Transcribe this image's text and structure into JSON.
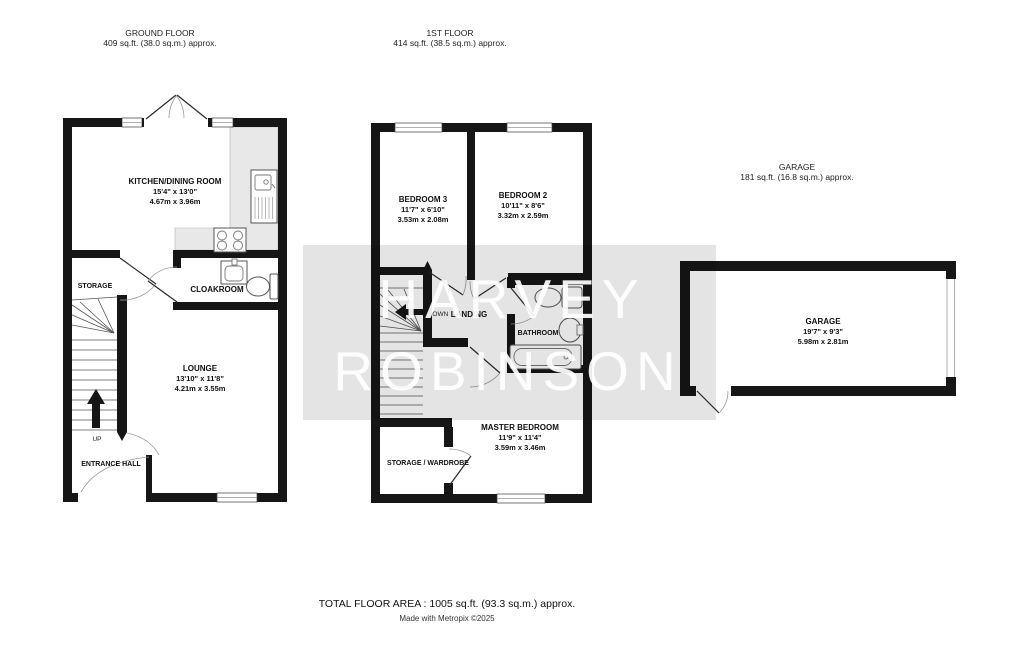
{
  "floors": {
    "ground": {
      "title": "GROUND FLOOR",
      "area": "409 sq.ft. (38.0 sq.m.) approx.",
      "rooms": {
        "kitchen": {
          "name": "KITCHEN/DINING ROOM",
          "imperial": "15'4\"  x 13'0\"",
          "metric": "4.67m  x 3.96m"
        },
        "lounge": {
          "name": "LOUNGE",
          "imperial": "13'10\"  x 11'8\"",
          "metric": "4.21m  x 3.55m"
        },
        "storage": {
          "name": "STORAGE"
        },
        "cloakroom": {
          "name": "CLOAKROOM"
        },
        "entrance_hall": {
          "name": "ENTRANCE HALL"
        },
        "stairs_label": "UP"
      }
    },
    "first": {
      "title": "1ST FLOOR",
      "area": "414 sq.ft. (38.5 sq.m.) approx.",
      "rooms": {
        "bedroom3": {
          "name": "BEDROOM 3",
          "imperial": "11'7\"  x 6'10\"",
          "metric": "3.53m  x 2.08m"
        },
        "bedroom2": {
          "name": "BEDROOM 2",
          "imperial": "10'11\"  x 8'6\"",
          "metric": "3.32m  x 2.59m"
        },
        "master": {
          "name": "MASTER BEDROOM",
          "imperial": "11'9\"  x 11'4\"",
          "metric": "3.59m  x 3.46m"
        },
        "landing": {
          "name": "LANDING"
        },
        "bathroom": {
          "name": "BATHROOM"
        },
        "storage_wardrobe": {
          "name": "STORAGE / WARDROBE"
        },
        "stairs_label": "DOWN"
      }
    },
    "garage": {
      "title": "GARAGE",
      "area": "181 sq.ft. (16.8 sq.m.) approx.",
      "rooms": {
        "garage": {
          "name": "GARAGE",
          "imperial": "19'7\"  x 9'3\"",
          "metric": "5.98m  x 2.81m"
        }
      }
    }
  },
  "watermark": {
    "line1": "HARVEY",
    "line2": "ROBINSON"
  },
  "footer": {
    "total": "TOTAL FLOOR AREA : 1005 sq.ft. (93.3 sq.m.) approx.",
    "credit": "Made with Metropix ©2025"
  },
  "colors": {
    "wall": "#161616",
    "counter": "#e8e8e8",
    "watermark_band": "#e3e3e3",
    "background": "#ffffff"
  }
}
